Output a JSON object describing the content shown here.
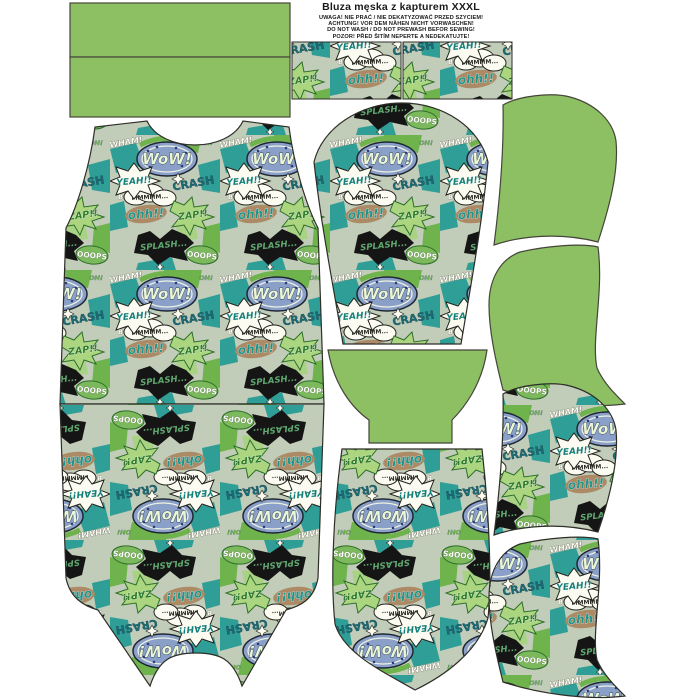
{
  "label": {
    "title": "Bluza męska z kapturem  XXXL",
    "warnings": [
      "UWAGA! NIE PRAĆ / NIE DEKATYZOWAĆ PRZED SZYCIEM!",
      "ACHTUNG! VOR DEM NÄHEN NICHT VORWASCHEN!",
      "DO NOT WASH / DO NOT PREWASH BEFOR SEWING!",
      "POZOR! PŘED ŠITÍM NEPERTE A NEDEKATUJTE!"
    ]
  },
  "print_words": {
    "wow": "WoW!",
    "yeah": "YEAH!!",
    "crash": "CRASH",
    "splash": "SPLASH...",
    "zap": "ZAP!!",
    "ooops": "OOOPS",
    "mmm": "MMMMM...",
    "oh": "OH!",
    "boom": "BOOM",
    "wham": "WHAM!",
    "ohh": "ohh!!"
  },
  "colors": {
    "panel_green": "#8dbf63",
    "piece_outline": "#45453a",
    "print_teal": "#2f9e97",
    "print_green": "#6fb34c",
    "print_lime": "#a9d284",
    "print_navy": "#2c3a7e",
    "print_tan": "#ad8a66",
    "print_dark_teal": "#1d6b75",
    "print_black": "#151515",
    "print_white": "#fbfbf2",
    "halftone_blue": "#8aa0c8"
  }
}
